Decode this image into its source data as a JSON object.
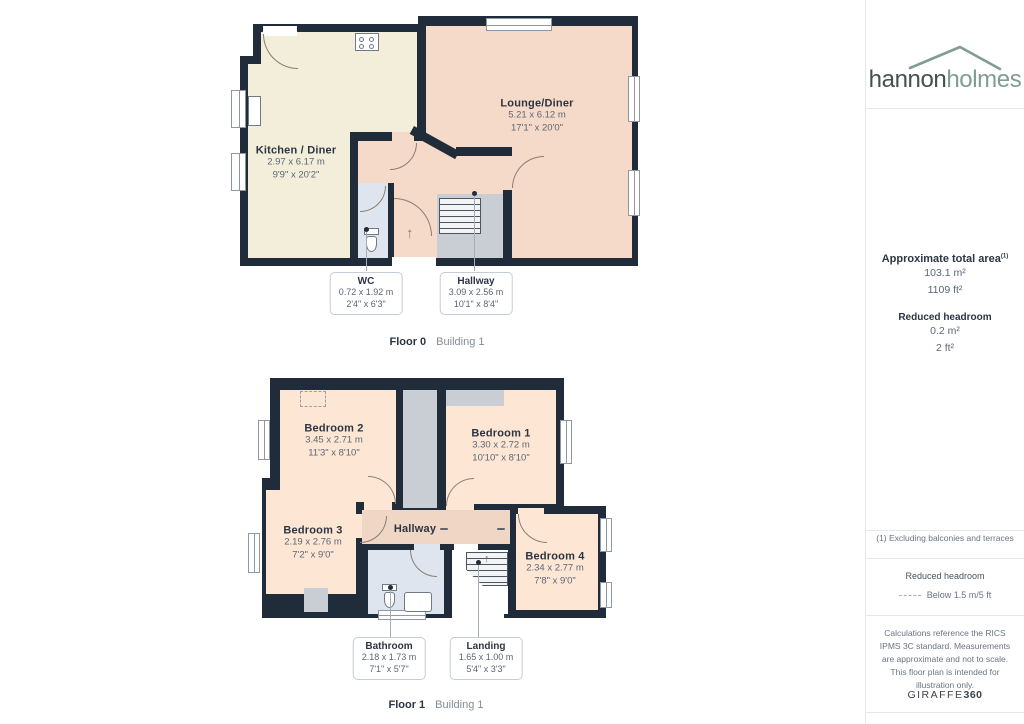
{
  "sidebar": {
    "logo": {
      "part1": "hannon",
      "part2": "holmes"
    },
    "area_summary": {
      "title": "Approximate total area",
      "superscript": "(1)",
      "sqm": "103.1 m²",
      "sqft": "1109 ft²",
      "reduced_title": "Reduced headroom",
      "reduced_sqm": "0.2 m²",
      "reduced_sqft": "2 ft²"
    },
    "footnote": "(1) Excluding balconies and terraces",
    "legend": {
      "title": "Reduced headroom",
      "label": "Below 1.5 m/5 ft"
    },
    "disclaimer": "Calculations reference the RICS IPMS 3C standard. Measurements are approximate and not to scale. This floor plan is intended for illustration only.",
    "brand": {
      "name": "GIRAFFE",
      "suffix": "360"
    }
  },
  "floor0": {
    "label": "Floor 0",
    "building": "Building 1",
    "rooms": {
      "kitchen": {
        "name": "Kitchen / Diner",
        "metric": "2.97 x 6.17 m",
        "imperial": "9'9\" x 20'2\""
      },
      "lounge": {
        "name": "Lounge/Diner",
        "metric": "5.21 x 6.12 m",
        "imperial": "17'1\" x 20'0\""
      },
      "wc": {
        "name": "WC",
        "metric": "0.72 x 1.92 m",
        "imperial": "2'4\" x 6'3\""
      },
      "hallway": {
        "name": "Hallway",
        "metric": "3.09 x 2.56 m",
        "imperial": "10'1\" x 8'4\""
      }
    }
  },
  "floor1": {
    "label": "Floor 1",
    "building": "Building 1",
    "rooms": {
      "bedroom1": {
        "name": "Bedroom 1",
        "metric": "3.30 x 2.72 m",
        "imperial": "10'10\" x 8'10\""
      },
      "bedroom2": {
        "name": "Bedroom 2",
        "metric": "3.45 x 2.71 m",
        "imperial": "11'3\" x 8'10\""
      },
      "bedroom3": {
        "name": "Bedroom 3",
        "metric": "2.19 x 2.76 m",
        "imperial": "7'2\" x 9'0\""
      },
      "bedroom4": {
        "name": "Bedroom 4",
        "metric": "2.34 x 2.77 m",
        "imperial": "7'8\" x 9'0\""
      },
      "hallway": {
        "name": "Hallway"
      },
      "bathroom": {
        "name": "Bathroom",
        "metric": "2.18 x 1.73 m",
        "imperial": "7'1\" x 5'7\""
      },
      "landing": {
        "name": "Landing",
        "metric": "1.65 x 1.00 m",
        "imperial": "5'4\" x 3'3\""
      }
    }
  },
  "icons": {
    "entrance_arrow": "↑",
    "stairs_arrow": "↑"
  },
  "colors": {
    "wall": "#212c3a",
    "kitchen_floor": "#f2eed9",
    "lounge_floor": "#f6dac9",
    "bedroom_floor": "#fde6d3",
    "hallway_floor": "#f0d6c5",
    "bathroom_floor": "#dfe5ef",
    "reduced_area": "#c9ced5",
    "brand_green": "#7f9e90",
    "brand_dark": "#45514f"
  }
}
